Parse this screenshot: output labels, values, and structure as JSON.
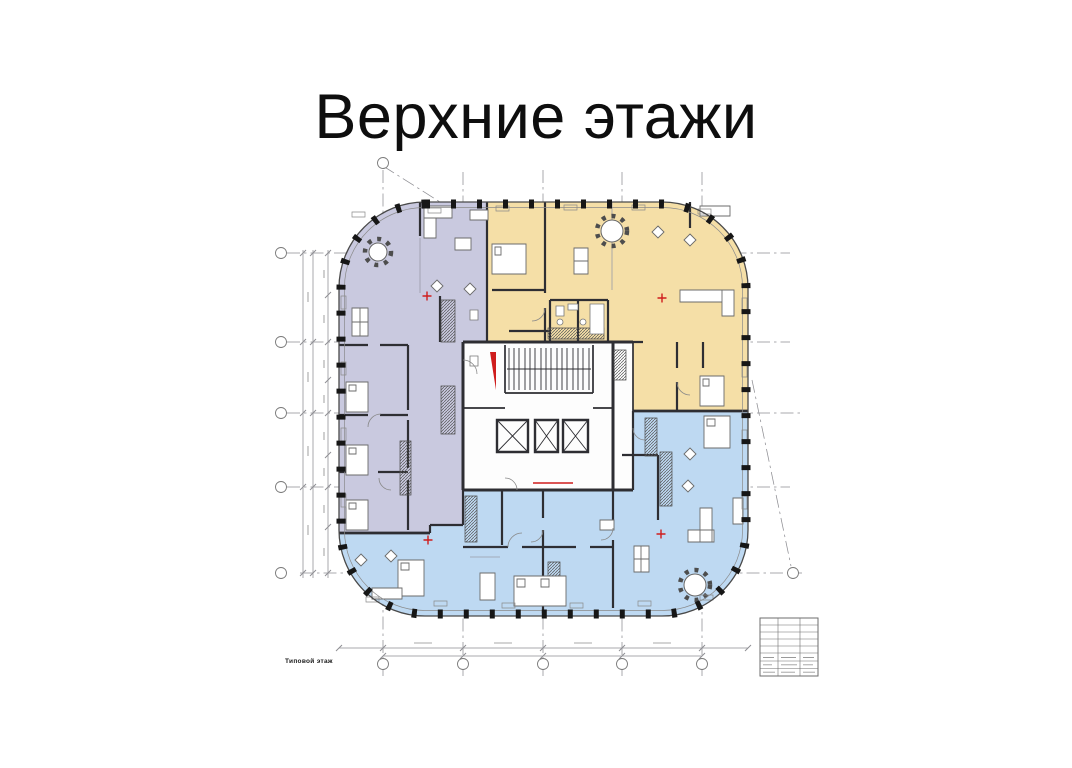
{
  "title": "Верхние этажи",
  "plan": {
    "caption": "Типовой этаж",
    "colors": {
      "building_fill": "#fdfdfd",
      "purple_zone": "#c9c9df",
      "yellow_zone": "#f5dfa7",
      "blue_zone": "#bed9f2",
      "wall": "#2e2e33",
      "annotation": "#8f8f94",
      "red_accent": "#cf1d1d"
    }
  }
}
